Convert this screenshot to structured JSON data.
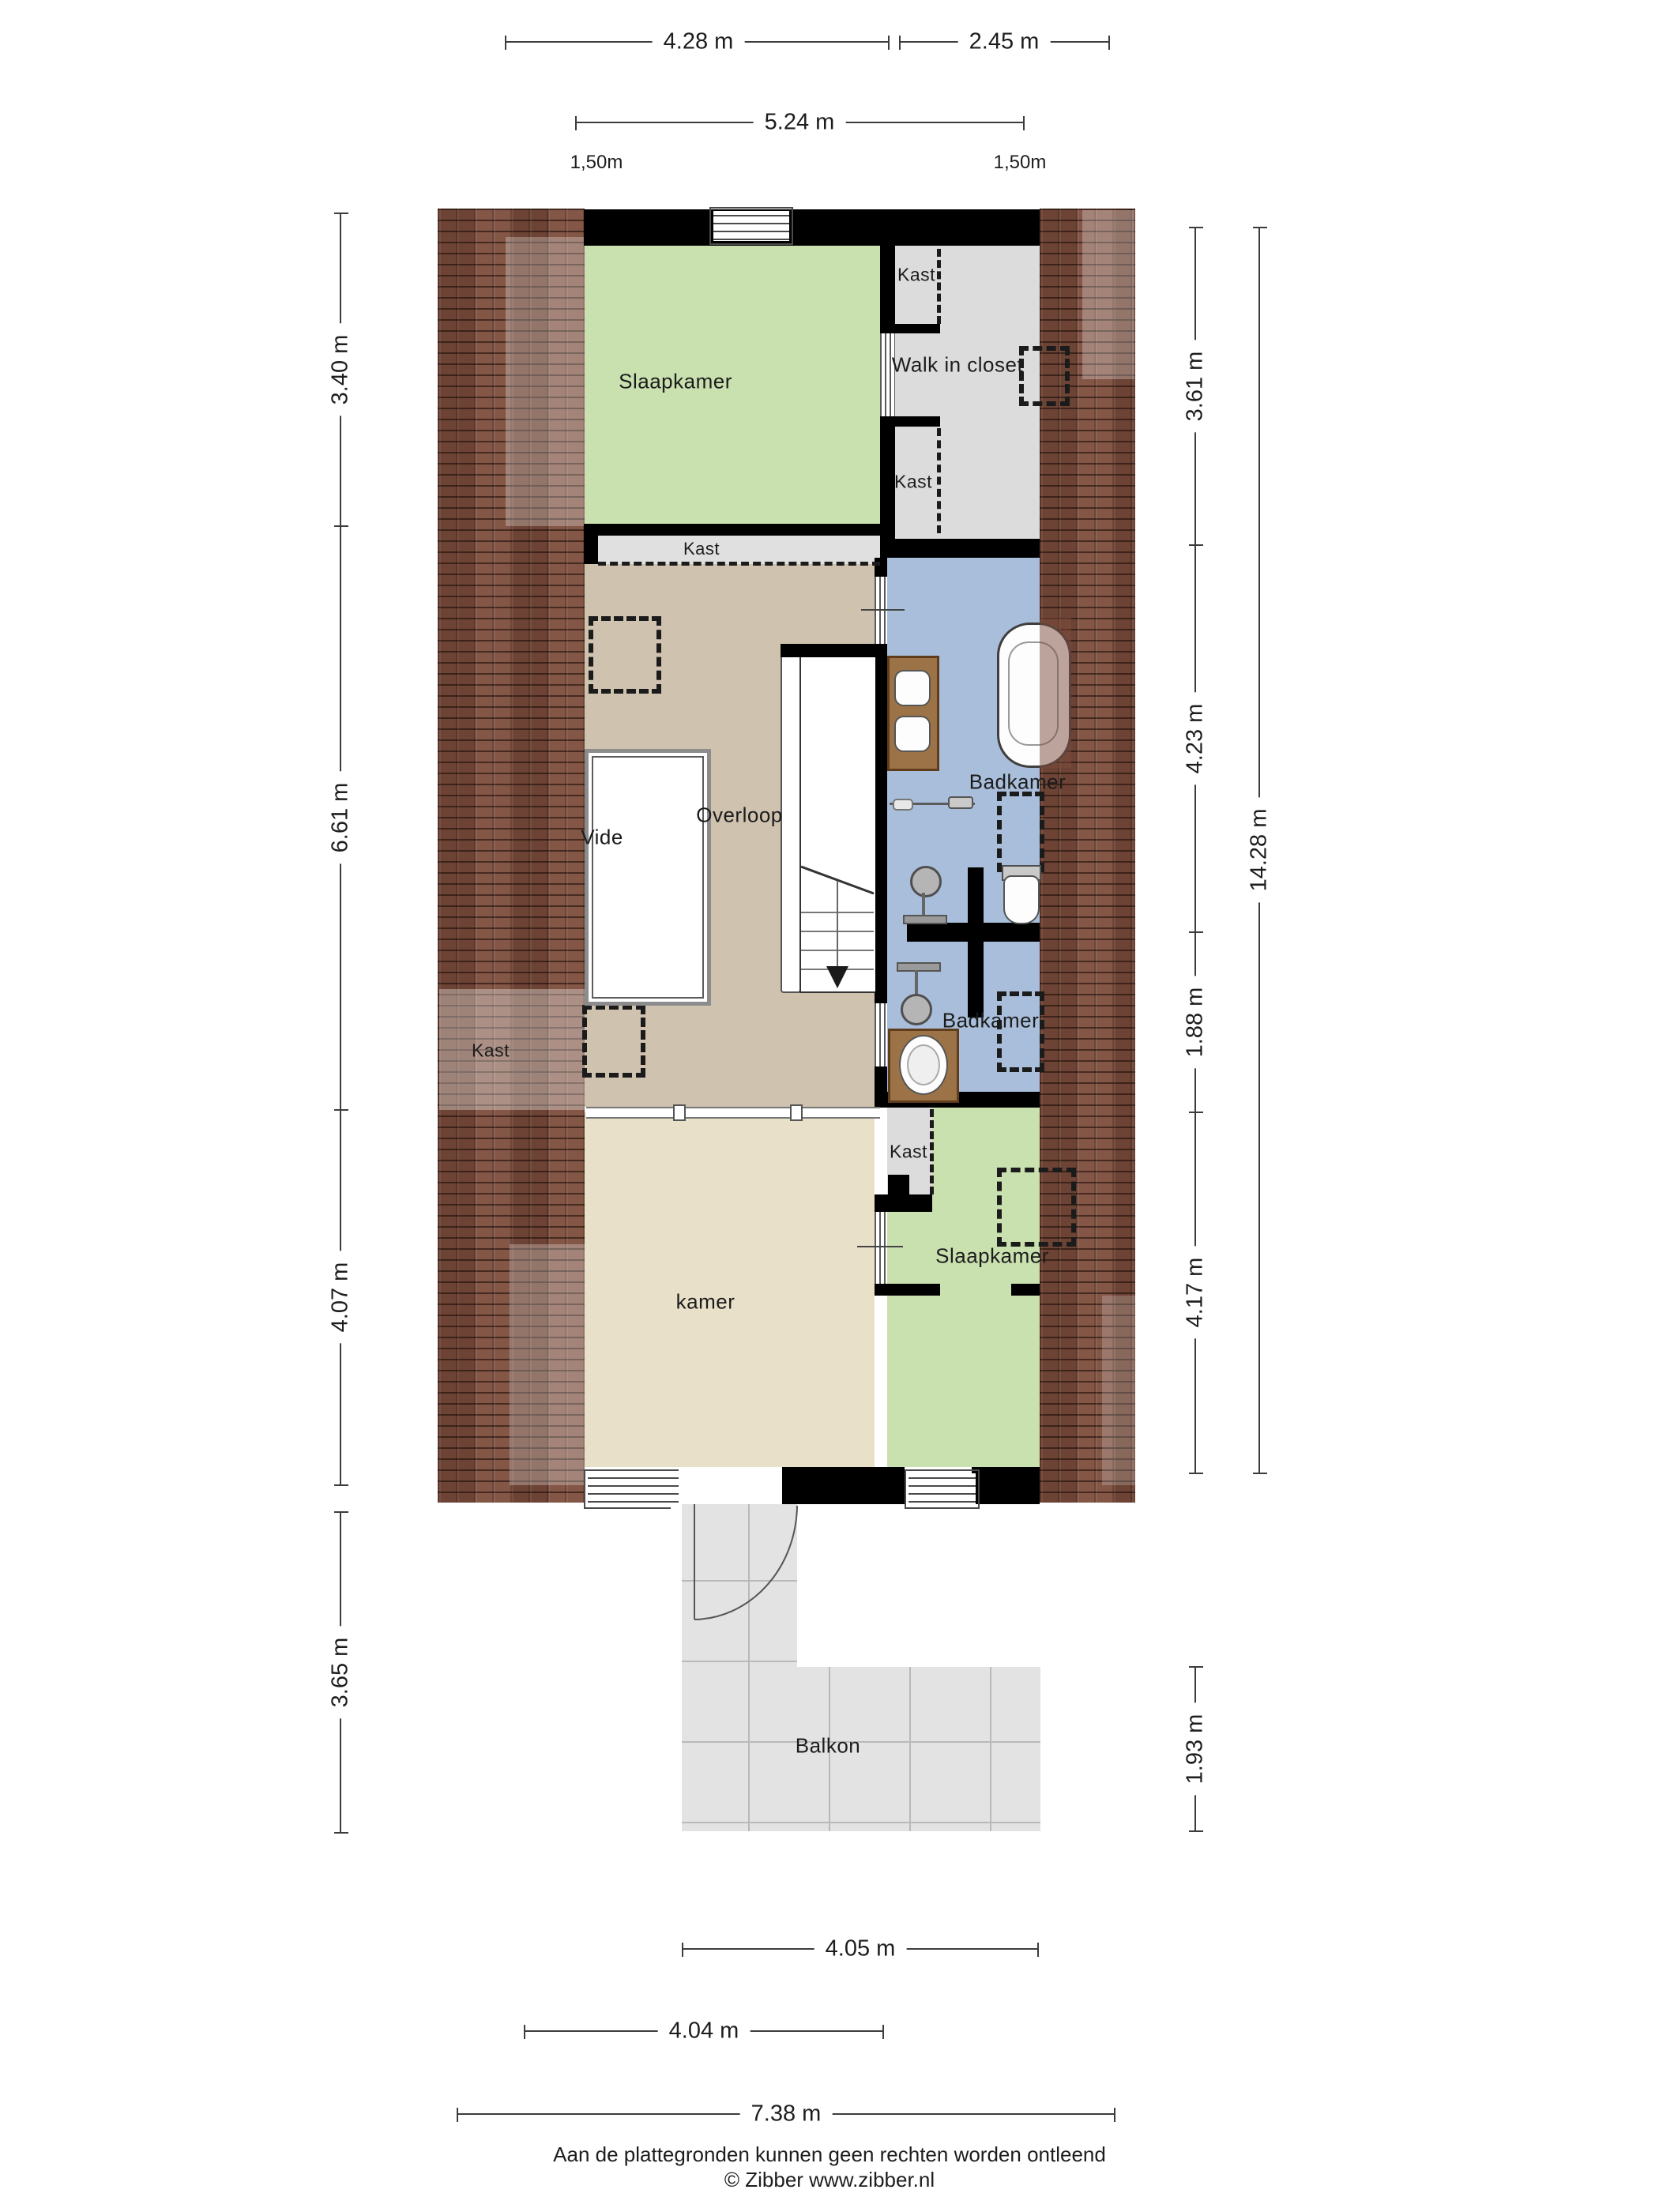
{
  "dimensions": {
    "top": [
      "4.28 m",
      "2.45 m",
      "5.24 m"
    ],
    "top_small": [
      "1,50m",
      "1,50m"
    ],
    "left": [
      "3.40 m",
      "6.61 m",
      "4.07 m",
      "3.65 m"
    ],
    "right": [
      "3.61 m",
      "4.23 m",
      "1.88 m",
      "4.17 m",
      "1.93 m"
    ],
    "right_total": "14.28 m",
    "bottom": [
      "4.05 m",
      "4.04 m",
      "7.38 m"
    ]
  },
  "rooms": {
    "slaapkamer_top": "Slaapkamer",
    "kast_top": "Kast",
    "walk_in_closet": "Walk in closet",
    "kast_mid": "Kast",
    "kast_under_bedroom": "Kast",
    "overloop": "Overloop",
    "vide": "Vide",
    "badkamer_boven": "Badkamer",
    "kast_roof": "Kast",
    "badkamer_onder": "Badkamer",
    "kast_small": "Kast",
    "slaapkamer_bottom": "Slaapkamer",
    "kamer": "kamer",
    "balkon": "Balkon"
  },
  "footer": {
    "line1": "Aan de plattegronden kunnen geen rechten worden ontleend",
    "line2": "© Zibber www.zibber.nl"
  },
  "colors": {
    "roof": "#7b4c3b",
    "bedroom_green": "#c9e0af",
    "bathroom_blue": "#a9bedb",
    "hallway_tan": "#cfc2ae",
    "room_cream": "#e8e0c8",
    "closet_gray": "#dcdcdc",
    "balcony_gray": "#e3e3e3",
    "wall": "#000000",
    "wood": "#9c7347"
  }
}
